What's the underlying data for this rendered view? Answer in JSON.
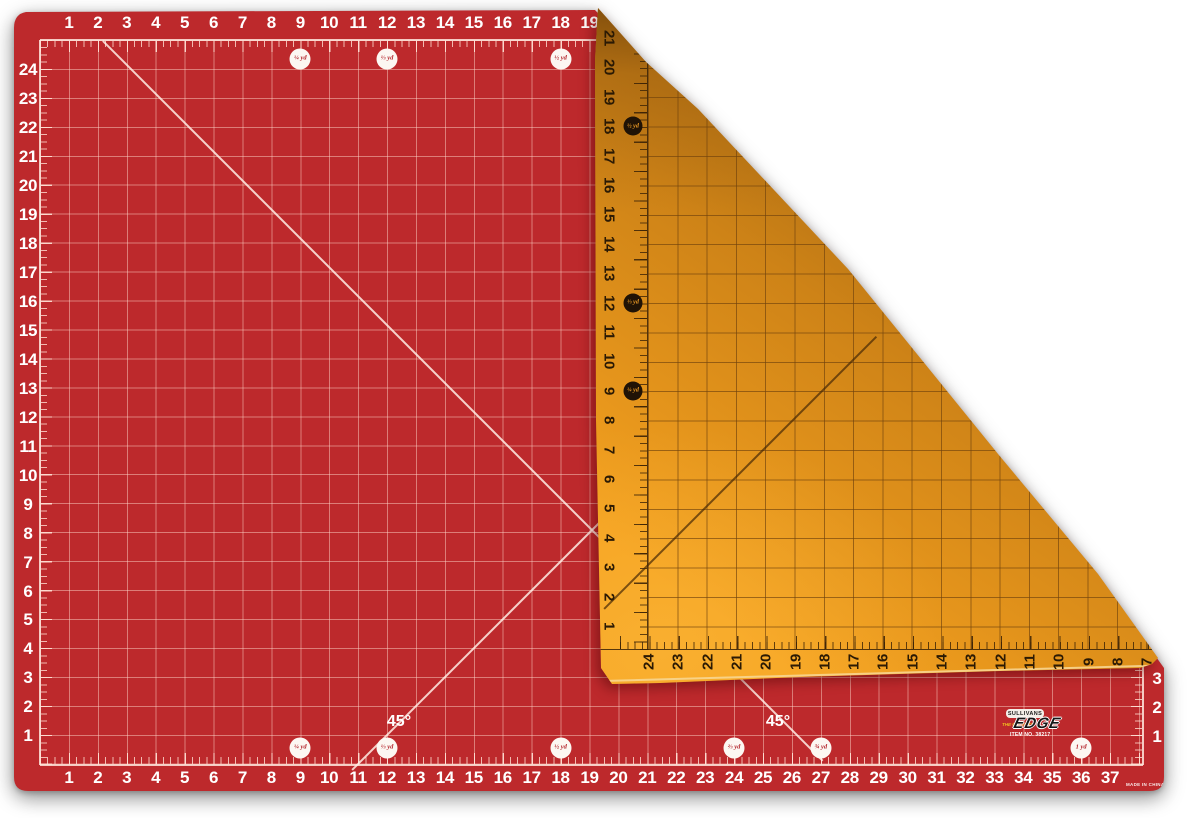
{
  "front": {
    "surface_color": "#bd292c",
    "grid_line_color": "#e8beb2",
    "number_color": "#ffffff",
    "top_ruler": [
      "1",
      "2",
      "3",
      "4",
      "5",
      "6",
      "7",
      "8",
      "9",
      "10",
      "11",
      "12",
      "13",
      "14",
      "15",
      "16",
      "17",
      "18",
      "19"
    ],
    "bottom_ruler": [
      "1",
      "2",
      "3",
      "4",
      "5",
      "6",
      "7",
      "8",
      "9",
      "10",
      "11",
      "12",
      "13",
      "14",
      "15",
      "16",
      "17",
      "18",
      "19",
      "20",
      "21",
      "22",
      "23",
      "24",
      "25",
      "26",
      "27",
      "28",
      "29",
      "30",
      "31",
      "32",
      "33",
      "34",
      "35",
      "36",
      "37"
    ],
    "left_ruler": [
      "24",
      "23",
      "22",
      "21",
      "20",
      "19",
      "18",
      "17",
      "16",
      "15",
      "14",
      "13",
      "12",
      "11",
      "10",
      "9",
      "8",
      "7",
      "6",
      "5",
      "4",
      "3",
      "2",
      "1"
    ],
    "right_ruler": [
      "3",
      "2",
      "1"
    ],
    "angle_labels": [
      {
        "text": "45°"
      },
      {
        "text": "45°"
      }
    ],
    "yard_markers_top": [
      {
        "label": "¼ yd",
        "inches": 9
      },
      {
        "label": "⅓ yd",
        "inches": 12
      },
      {
        "label": "½ yd",
        "inches": 18
      }
    ],
    "yard_markers_bottom": [
      {
        "label": "¼ yd",
        "inches": 9
      },
      {
        "label": "⅓ yd",
        "inches": 12
      },
      {
        "label": "½ yd",
        "inches": 18
      },
      {
        "label": "⅔ yd",
        "inches": 24
      },
      {
        "label": "¾ yd",
        "inches": 27
      },
      {
        "label": "1 yd",
        "inches": 36
      }
    ],
    "fine_print": "MADE IN CHINA"
  },
  "back_flap": {
    "surface_color": "#f6a21f",
    "grid_line_color": "#8a5a14",
    "number_color": "#2b1a04",
    "side_ruler": [
      "21",
      "20",
      "19",
      "18",
      "17",
      "16",
      "15",
      "14",
      "13",
      "12",
      "11",
      "10",
      "9",
      "8",
      "7",
      "6",
      "5",
      "4",
      "3",
      "2",
      "1"
    ],
    "edge_ruler": [
      "24",
      "23",
      "22",
      "21",
      "20",
      "19",
      "18",
      "17",
      "16",
      "15",
      "14",
      "13",
      "12",
      "11",
      "10",
      "9",
      "8",
      "7"
    ],
    "yard_markers": [
      {
        "label": "½ yd",
        "inches": 18
      },
      {
        "label": "⅓ yd",
        "inches": 12
      },
      {
        "label": "¼ yd",
        "inches": 9
      }
    ]
  },
  "logo": {
    "brand": "SULLIVANS",
    "tagline": "THE CUTTING",
    "product": "EDGE",
    "item_number": "ITEM NO. 38217"
  }
}
